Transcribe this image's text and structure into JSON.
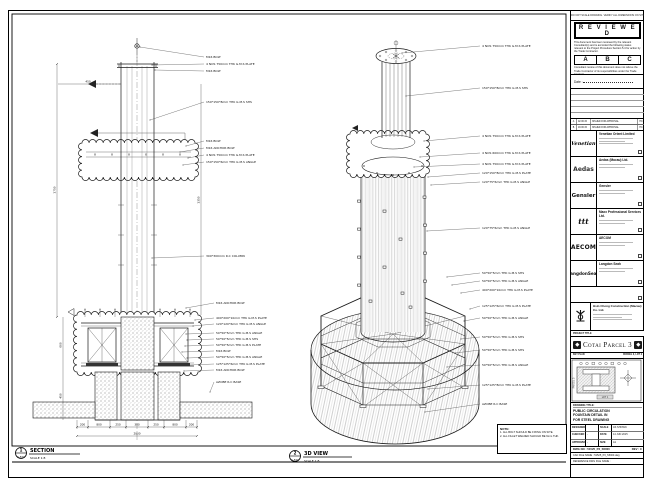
{
  "sheet": {
    "top_strip": "DO NOT SCALE DRAWING. VERIFY ALL DIMENSIONS ON SITE.",
    "reviewed": {
      "title": "R E V I E W E D",
      "body1": "This document has been reviewed by the relevant Consultant(s) and is accorded the following status relevant to the Project Procedure Section 5.4 for action by the Trade Contractor.",
      "opt_a": "A",
      "opt_b": "B",
      "opt_c": "C",
      "body2": "Consultant review of this document does not relieve the Trade Contractor of its responsibilities under the Trade Contract.",
      "date_label": "Date :"
    },
    "revisions": [
      {
        "no": "A",
        "date": "02.06.15",
        "desc": "ISSUED FOR APPROVAL",
        "by": "HC"
      },
      {
        "no": "B",
        "date": "18.06.15",
        "desc": "ISSUED FOR APPROVAL",
        "by": "HC"
      }
    ],
    "consultants": [
      {
        "logo": "Venetian",
        "name": "Venetian Orient Limited"
      },
      {
        "logo": "Aedas",
        "name": "Aedas (Macau) Ltd."
      },
      {
        "logo": "Gensler",
        "name": "Gensler"
      },
      {
        "logo": "ttt",
        "name": "Maxx Professional Services Ltd."
      },
      {
        "logo": "AECOM",
        "name": "AECOM"
      },
      {
        "logo": "LangdonSeah",
        "name": "Langdon Seah"
      }
    ],
    "contractor": {
      "name": "Hsin Chong Construction (Macau) Co. Ltd."
    },
    "project": {
      "band_label": "PROJECT TITLE",
      "title": "Cotai Parcel 3"
    },
    "key_plan": {
      "label": "KEY PLAN",
      "right_label": "PARCEL 3, LOT 2",
      "left_label": "PARCEL 5",
      "bottom_label": "LOT 1"
    },
    "title_block": {
      "drawing_title_label": "DRAWING TITLE:",
      "t1": "PUBLIC CIRCULATION",
      "t2": "FOUNTAIN DETAIL IN",
      "t3": "FOR STEEL DRAWING",
      "f_designed": "DESIGNED",
      "v_designed": "",
      "f_scale": "SCALE",
      "v_scale": "AS SHOWN",
      "f_checked": "CHECKED",
      "v_checked": "-",
      "f_date": "DATE",
      "v_date": "14 JUN 2015",
      "f_approved": "APPROVED",
      "v_approved": "-",
      "f_size": "SIZE",
      "v_size": "A1",
      "dwg_no": "DWG NO : 51525_P3_S5000",
      "rev": "REV : C",
      "cad": "CAD FILE NAME : 51525_P3_S5000.dwg",
      "ref": "REFERENCE DWG FILE NAME :"
    }
  },
  "section": {
    "bubble_top": "1",
    "bubble_bottom": "S-500",
    "title": "SECTION",
    "scale": "SCALE 1:8",
    "callouts": [
      "M16 BOLT",
      "4 NOS 750mm THK G.M.S PLATE",
      "M16 BOLT",
      "150*150*8mm THK G.M.S SHS",
      "M16 BOLT",
      "M16 ANCHOR BOLT",
      "4 NOS 750mm THK G.M.S PLATE",
      "150*150*6mm THK G.M.S ANGLE",
      "300*300mm R.C COLUMN",
      "M16 ANCHOR BOLT",
      "400*200*10mm THK G.M.S PLATE",
      "120*120*6mm THK G.M.S ANGLE",
      "50*50*5mm THK G.M.S ANGLE",
      "50*50*5mm THK G.M.S SHS",
      "50*50*5mm THK G.M.S PLATE",
      "M16 BOLT",
      "50*50*5mm THK G.M.S ANGLE",
      "125*125*6mm THK G.M.S PLATE",
      "M16 ANCHOR BOLT",
      "AZOBE R.C BASE"
    ],
    "dims": {
      "b1": "200",
      "b2": "800",
      "b3": "250",
      "b4": "300",
      "b5": "250",
      "b6": "800",
      "b7": "200",
      "total": "2800",
      "v1": "1750",
      "v2": "600",
      "v3": "450",
      "v4": "1350",
      "top": "450"
    }
  },
  "iso": {
    "bubble_top": "2",
    "bubble_bottom": "S-500",
    "title": "3D VIEW",
    "scale": "SCALE 1:8",
    "callouts": [
      "4 NOS 750mm THK G.M.S PLATE",
      "150*150*8mm THK G.M.S SHS",
      "4 NOS 750mm THK G.M.S PLATE",
      "4 NOS 600mm THK G.M.S PLATE",
      "4 NOS 750mm THK G.M.S PLATE",
      "120*150*8mm THK G.M.S PLATE",
      "120*75*6mm THK G.M.S ANGLE",
      "120*75*6mm THK G.M.S ANGLE",
      "50*50*5mm THK G.M.S SHS",
      "50*50*5mm THK G.M.S ANGLE",
      "400*200*10mm THK G.M.S PLATE",
      "125*125*6mm THK G.M.S PLATE",
      "50*50*5mm THK G.M.S ANGLE",
      "50*50*5mm THK G.M.S SHS",
      "50*50*5mm THK G.M.S SHS",
      "50*50*5mm THK G.M.S ANGLE",
      "125*125*8mm THK G.M.S PLATE",
      "AZOBE R.C BASE"
    ]
  },
  "notes": {
    "title": "NOTE:",
    "l1": "1. ALL BOLT SHOULD BE FIXING ON SITE.",
    "l2": "2. ALL FILLET WELDED SHOULD BE 6mm THK."
  }
}
